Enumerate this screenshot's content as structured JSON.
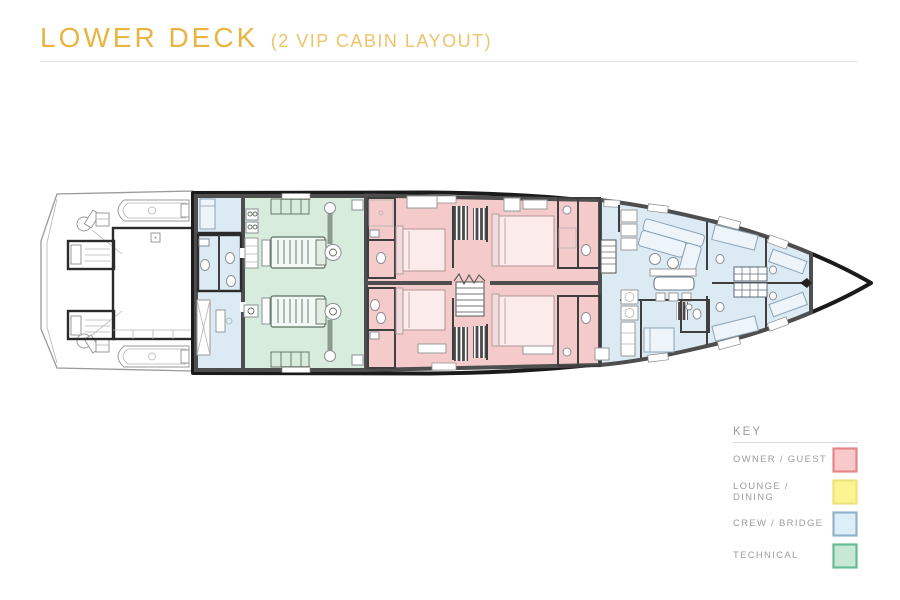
{
  "header": {
    "title": "LOWER DECK",
    "subtitle": "(2 VIP CABIN LAYOUT)",
    "title_color": "#e9b440",
    "subtitle_color": "#edc468"
  },
  "legend": {
    "heading": "KEY",
    "items": [
      {
        "label": "OWNER / GUEST",
        "fill": "#f7c9ca",
        "border": "#e4858b"
      },
      {
        "label": "LOUNGE / DINING",
        "fill": "#fbf490",
        "border": "#eee27a"
      },
      {
        "label": "CREW / BRIDGE",
        "fill": "#dceef7",
        "border": "#8fb3cd"
      },
      {
        "label": "TECHNICAL",
        "fill": "#c7e9d4",
        "border": "#66bd93"
      }
    ]
  },
  "plan": {
    "zones": {
      "owner_guest": "#f5caca",
      "crew_bridge": "#dceaf4",
      "technical": "#d7ecdc"
    },
    "hull_color": "#1b1b1b",
    "wall_color": "#4e4e4e",
    "stern_outline_color": "#9a9a9a"
  }
}
